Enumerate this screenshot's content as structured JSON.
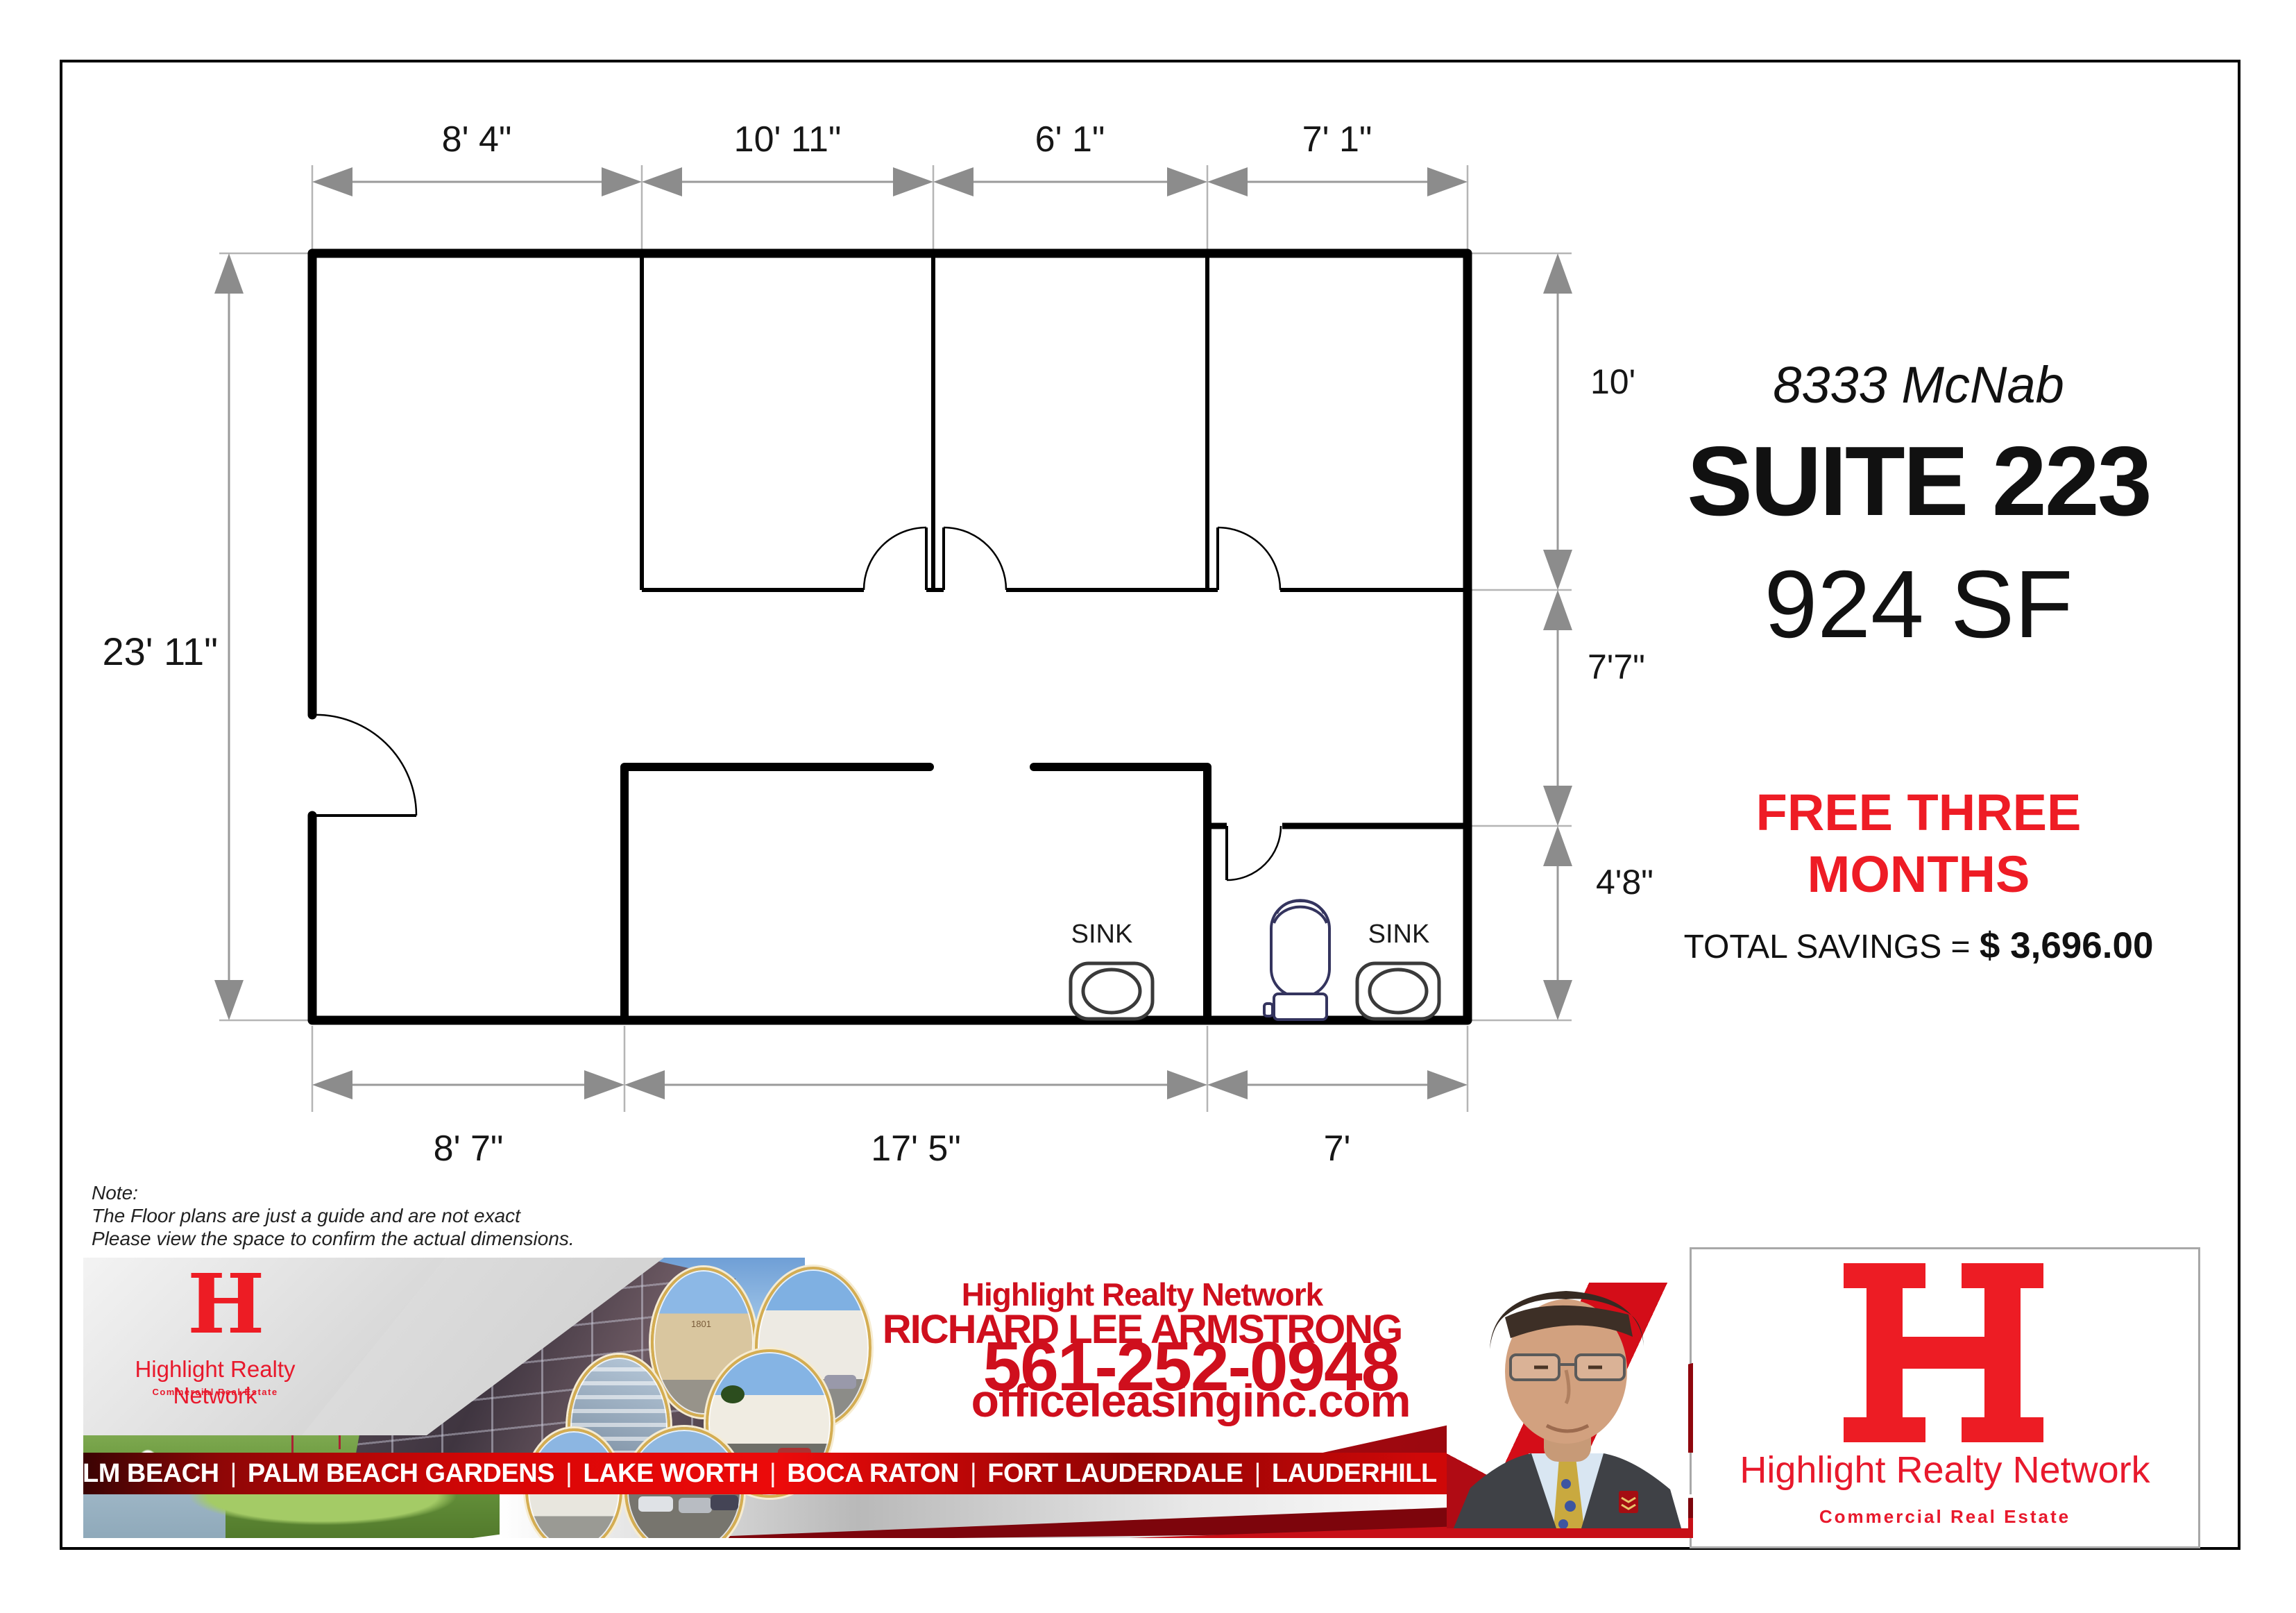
{
  "plan": {
    "dims_top": [
      "8' 4\"",
      "10' 11\"",
      "6' 1\"",
      "7' 1\""
    ],
    "dim_left": "23' 11\"",
    "dims_right": [
      "10'",
      "7'7\"",
      "4'8\""
    ],
    "dims_bottom": [
      "8' 7\"",
      "17' 5\"",
      "7'"
    ],
    "sink_left": "SINK",
    "sink_right": "SINK"
  },
  "listing": {
    "address": "8333 McNab",
    "suite": "SUITE 223",
    "area": "924 SF",
    "promo_line1": "FREE THREE",
    "promo_line2": "MONTHS",
    "savings_label": "TOTAL SAVINGS = ",
    "savings_value": "$ 3,696.00"
  },
  "note": {
    "title": "Note:",
    "line1": "The Floor plans are just a guide and are not exact",
    "line2": "Please view the space to confirm the actual dimensions."
  },
  "banner": {
    "brand": "Highlight Realty Network",
    "agent": "RICHARD LEE ARMSTRONG",
    "phone": "561-252-0948",
    "website": "officeleasinginc.com",
    "sep": "|",
    "cities": [
      "WEST PALM BEACH",
      "PALM BEACH GARDENS",
      "LAKE WORTH",
      "BOCA RATON",
      "FORT LAUDERDALE",
      "LAUDERHILL",
      "TAMARAC"
    ],
    "inset_building_label": "1801",
    "small_logo": {
      "letter": "H",
      "name": "Highlight Realty Network",
      "tagline": "Commercial Real Estate"
    }
  },
  "logo_box": {
    "letter": "H",
    "name": "Highlight Realty Network",
    "tagline": "Commercial Real Estate"
  },
  "colors": {
    "promo_red": "#ee1c25",
    "banner_red": "#cf0f1d",
    "logo_red": "#ed1c24",
    "dim_gray": "#8c8c8c"
  }
}
